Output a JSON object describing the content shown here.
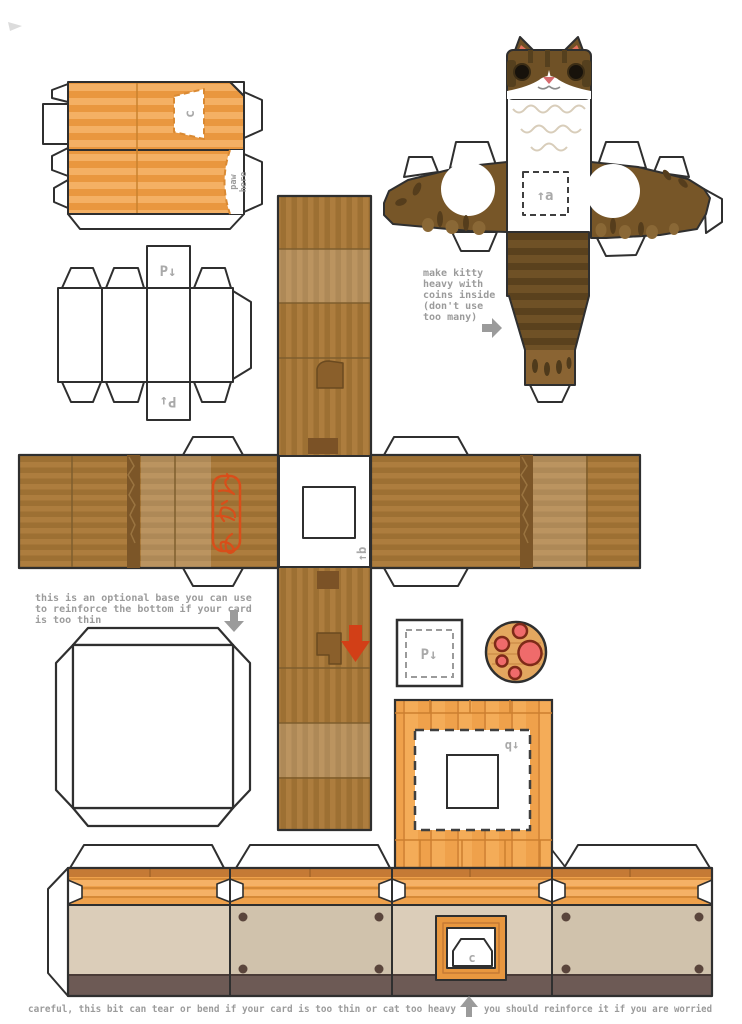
{
  "colors": {
    "outline": "#2f2f2f",
    "cardboard_orange": "#efa14b",
    "cardboard_orange_light": "#f4b469",
    "cardboard_brown": "#ad7d3e",
    "cardboard_brown_dark": "#9d7033",
    "cat_brown": "#6f5126",
    "cat_dark_spot": "#55401e",
    "ear_pink": "#e2705c",
    "paw_pink": "#ef6b6b",
    "paw_outline": "#7e2a18",
    "stamp_red": "#d84e1a",
    "arrow_red": "#d23f17",
    "note_gray": "#9b9b9b",
    "label_gray": "#a9a9a9",
    "beige_panel": "#dbcdb9",
    "beige_panel_dark": "#d0c2ac",
    "dark_trim": "#6d5a55"
  },
  "pieces": {
    "lid_flaps": {
      "slot_label": "c",
      "paw_note_line1": "paw",
      "paw_note_line2": "here"
    },
    "pillar_strip": {
      "top_label": "P↓",
      "bottom_label": "P↓"
    },
    "cat": {
      "coin_slot_label": "↑a",
      "note_lines": [
        "make kitty",
        "heavy with",
        "coins inside",
        "(don't use",
        "too many)"
      ]
    },
    "box_cross": {
      "stamp_label": "みかん",
      "window_label": "↑b"
    },
    "optional_base": {
      "note_lines": [
        "this is an optional base you can use",
        "to reinforce the bottom if your card",
        "is too thin"
      ]
    },
    "p_marker_square": {
      "label": "P↓"
    },
    "back_panel": {
      "window_label": "↑b"
    },
    "front_strip": {
      "flap_label": "c"
    },
    "footer": {
      "note_before_arrow": "careful, this bit can tear or bend if your card is too thin or cat too heavy",
      "note_after_arrow": "you should reinforce it if you are worried"
    }
  }
}
